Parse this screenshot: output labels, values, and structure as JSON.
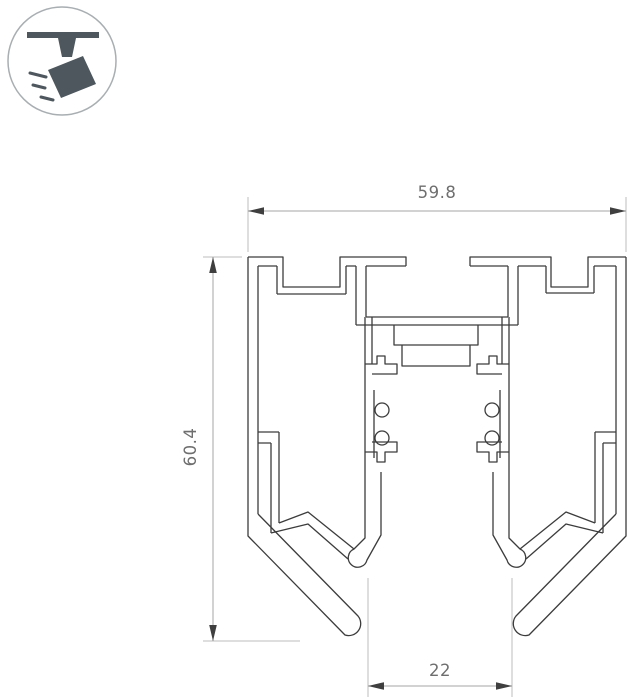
{
  "badge": {
    "icon": "track-spotlight-icon",
    "glyph_color": "#4d575d",
    "ring_color": "#a8aeb1"
  },
  "drawing": {
    "type": "profile-cross-section",
    "line_color": "#3c3c3c",
    "dimensions": {
      "top_width": {
        "value": "59.8"
      },
      "left_height": {
        "value": "60.4"
      },
      "bottom_width": {
        "value": "22"
      }
    },
    "dim_style": {
      "ext_line_color": "#bdbdbd",
      "dim_line_color": "#a6a6a6",
      "arrow_color": "#3f3f3f",
      "text_color": "#6e6e6e"
    }
  }
}
